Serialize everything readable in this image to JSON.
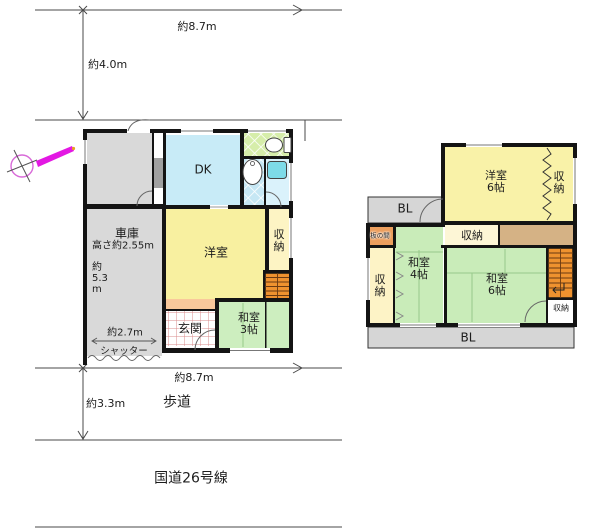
{
  "site": {
    "dim_top_width": "約8.7m",
    "dim_left_height": "約4.0m",
    "dim_bottom_width": "約8.7m",
    "dim_road_depth": "約3.3m",
    "sidewalk_label": "歩道",
    "road_label": "国道26号線"
  },
  "floor1": {
    "dk_label": "DK",
    "garage_label": "車庫",
    "garage_height": "高さ約2.55m",
    "garage_depth": "約\n5.3\nm",
    "garage_width": "約2.7m",
    "shutter_label": "シャッター",
    "western_room_label": "洋室",
    "storage_label": "収\n納",
    "entrance_label": "玄関",
    "japanese_room3_label": "和室\n3帖"
  },
  "floor2": {
    "western_room6_label": "洋室\n6帖",
    "storage_right_label": "収\n納",
    "balcony_top_label": "BL",
    "itanoma_label": "板の間",
    "storage_mid_label": "収納",
    "japanese_room4_label": "和室\n4帖",
    "storage_left_label": "収\n納",
    "japanese_room6_label": "和室\n6帖",
    "storage_br_label": "収納",
    "balcony_bottom_label": "BL"
  },
  "colors": {
    "wall": "#141414",
    "tatami_green": "#c9ecb9",
    "room_yellow": "#f8f0a0",
    "dk_blue": "#c8ebf7",
    "garage_gray": "#d9d9d9",
    "stairs_orange": "#ef922f",
    "balcony_gray": "#d6d6d6",
    "corridor_tan": "#d5b285",
    "itanoma_orange": "#ec9e5d",
    "step_orange": "#f9c89b",
    "toilet_green": "#d6edaa",
    "bath_blue": "#c6e7f4",
    "compass_magenta": "#e318e3"
  }
}
